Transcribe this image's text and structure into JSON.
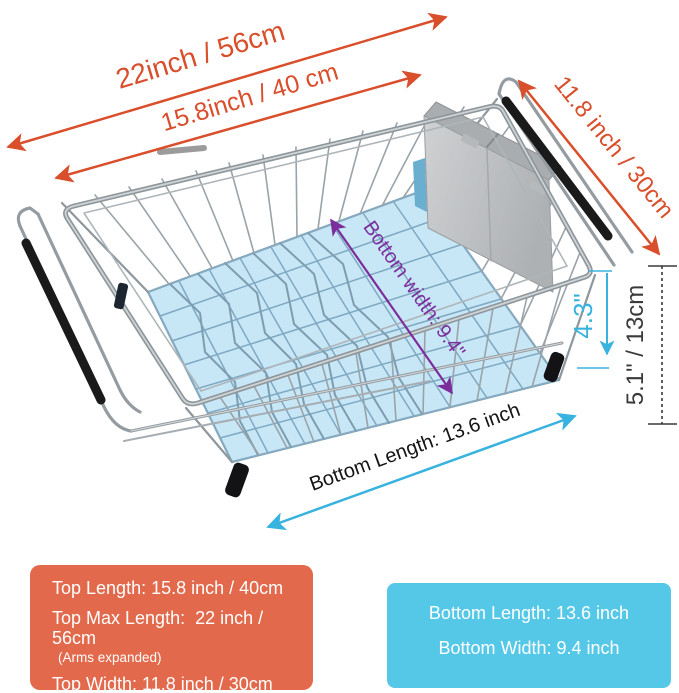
{
  "annotations": {
    "top_max_length": "22inch / 56cm",
    "top_length": "15.8inch / 40 cm",
    "top_width": "11.8 inch / 30cm",
    "basket_depth": "4.3\"",
    "overall_height": "5.1\" / 13cm",
    "bottom_width": "Bottom width: 9.4\"",
    "bottom_length": "Bottom Length: 13.6 inch"
  },
  "legend_top": {
    "top_length": "Top Length: 15.8 inch / 40cm",
    "top_max_length": "Top Max Length:  22 inch / 56cm",
    "top_max_note": "(Arms expanded)",
    "top_width": "Top Width: 11.8 inch / 30cm"
  },
  "legend_bottom": {
    "bottom_length": "Bottom Length: 13.6 inch",
    "bottom_width": "Bottom Width: 9.4 inch"
  },
  "colors": {
    "dimension_red": "#d94e2b",
    "dimension_purple": "#7c2d9c",
    "dimension_cyan": "#38b2de",
    "dimension_dark": "#3a3a3a",
    "text_black": "#141414",
    "top_legend_bg": "#e2694b",
    "bottom_legend_bg": "#55c8e8",
    "bottom_highlight": "#c7e6f6",
    "legend_text": "#ffffff"
  }
}
